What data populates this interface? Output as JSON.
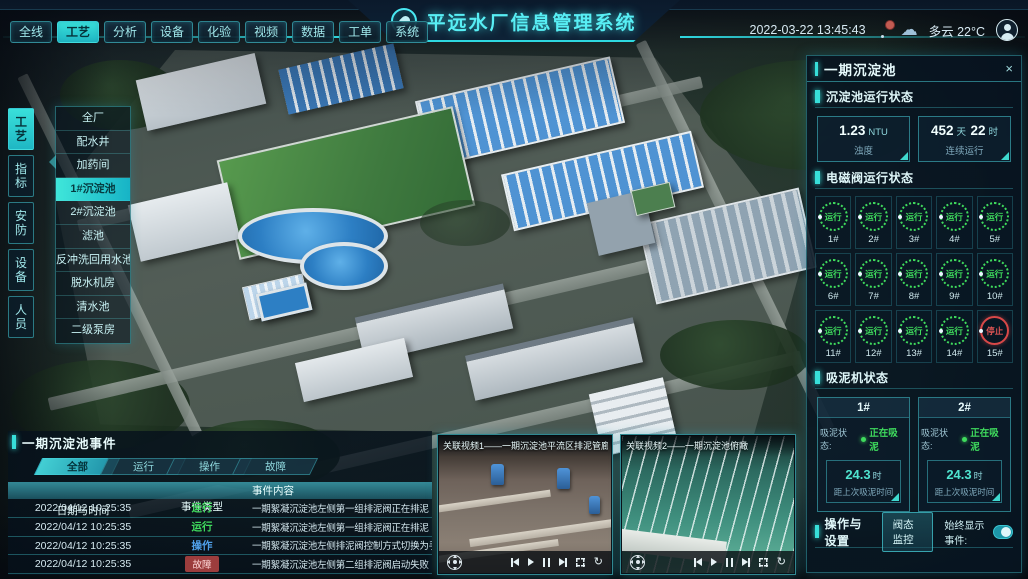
{
  "header": {
    "title": "平远水厂信息管理系统",
    "datetime": "2022-03-22 13:45:43",
    "weather": "多云 22°C",
    "nav": [
      {
        "label": "全线"
      },
      {
        "label": "工艺"
      },
      {
        "label": "分析"
      },
      {
        "label": "设备"
      },
      {
        "label": "化验"
      },
      {
        "label": "视频"
      },
      {
        "label": "数据"
      },
      {
        "label": "工单"
      },
      {
        "label": "系统"
      }
    ],
    "icons": {
      "logo": "water-drop-logo",
      "bell": "notification-bell",
      "cloud": "weather-cloud",
      "avatar": "user-avatar"
    }
  },
  "sidebar": {
    "tabs": [
      {
        "label": "工艺"
      },
      {
        "label": "指标"
      },
      {
        "label": "安防"
      },
      {
        "label": "设备"
      },
      {
        "label": "人员"
      }
    ],
    "menu": [
      {
        "label": "全厂"
      },
      {
        "label": "配水井"
      },
      {
        "label": "加药间"
      },
      {
        "label": "1#沉淀池"
      },
      {
        "label": "2#沉淀池"
      },
      {
        "label": "滤池"
      },
      {
        "label": "反冲洗回用水池"
      },
      {
        "label": "脱水机房"
      },
      {
        "label": "清水池"
      },
      {
        "label": "二级泵房"
      }
    ]
  },
  "panel": {
    "title": "一期沉淀池",
    "close": "×",
    "run_status": {
      "title": "沉淀池运行状态",
      "turbidity": {
        "num": "1.23",
        "unit": "NTU",
        "label": "浊度"
      },
      "uptime": {
        "num1": "452",
        "unit1": "天",
        "num2": "22",
        "unit2": "时",
        "label": "连续运行"
      }
    },
    "valves": {
      "title": "电磁阀运行状态",
      "items": [
        {
          "id": "1#",
          "status": "运行"
        },
        {
          "id": "2#",
          "status": "运行"
        },
        {
          "id": "3#",
          "status": "运行"
        },
        {
          "id": "4#",
          "status": "运行"
        },
        {
          "id": "5#",
          "status": "运行"
        },
        {
          "id": "6#",
          "status": "运行"
        },
        {
          "id": "7#",
          "status": "运行"
        },
        {
          "id": "8#",
          "status": "运行"
        },
        {
          "id": "9#",
          "status": "运行"
        },
        {
          "id": "10#",
          "status": "运行"
        },
        {
          "id": "11#",
          "status": "运行"
        },
        {
          "id": "12#",
          "status": "运行"
        },
        {
          "id": "13#",
          "status": "运行"
        },
        {
          "id": "14#",
          "status": "运行"
        },
        {
          "id": "15#",
          "status": "停止"
        }
      ]
    },
    "suction": {
      "title": "吸泥机状态",
      "machines": [
        {
          "id": "1#",
          "state_label": "吸泥状态:",
          "state": "正在吸泥",
          "num": "24.3",
          "unit": "时",
          "desc": "距上次吸泥时间"
        },
        {
          "id": "2#",
          "state_label": "吸泥状态:",
          "state": "正在吸泥",
          "num": "24.3",
          "unit": "时",
          "desc": "距上次吸泥时间"
        }
      ]
    },
    "ops": {
      "title": "操作与设置",
      "button": "阀态监控",
      "toggle_label": "始终显示事件:",
      "toggle_on": true
    }
  },
  "events": {
    "title": "一期沉淀池事件",
    "tabs": [
      {
        "label": "全部"
      },
      {
        "label": "运行"
      },
      {
        "label": "操作"
      },
      {
        "label": "故障"
      }
    ],
    "columns": [
      "日期与时间",
      "事件类型",
      "事件内容"
    ],
    "rows": [
      {
        "time": "2022/04/12 10:25:35",
        "type": "运行",
        "content": "一期絮凝沉淀池左侧第一组排泥阀正在排泥"
      },
      {
        "time": "2022/04/12 10:25:35",
        "type": "运行",
        "content": "一期絮凝沉淀池左侧第一组排泥阀正在排泥"
      },
      {
        "time": "2022/04/12 10:25:35",
        "type": "操作",
        "content": "一期絮凝沉淀池左侧排泥阀控制方式切换为手动"
      },
      {
        "time": "2022/04/12 10:25:35",
        "type": "故障",
        "content": "一期絮凝沉淀池左侧第二组排泥阀启动失败"
      }
    ]
  },
  "videos": [
    {
      "title": "关联视频1——一期沉淀池平流区排泥管廊"
    },
    {
      "title": "关联视频2——一期沉淀池俯瞰"
    }
  ],
  "media_icons": [
    "ptz-dpad",
    "skip-back",
    "play",
    "pause",
    "skip-forward",
    "fullscreen",
    "replay"
  ]
}
